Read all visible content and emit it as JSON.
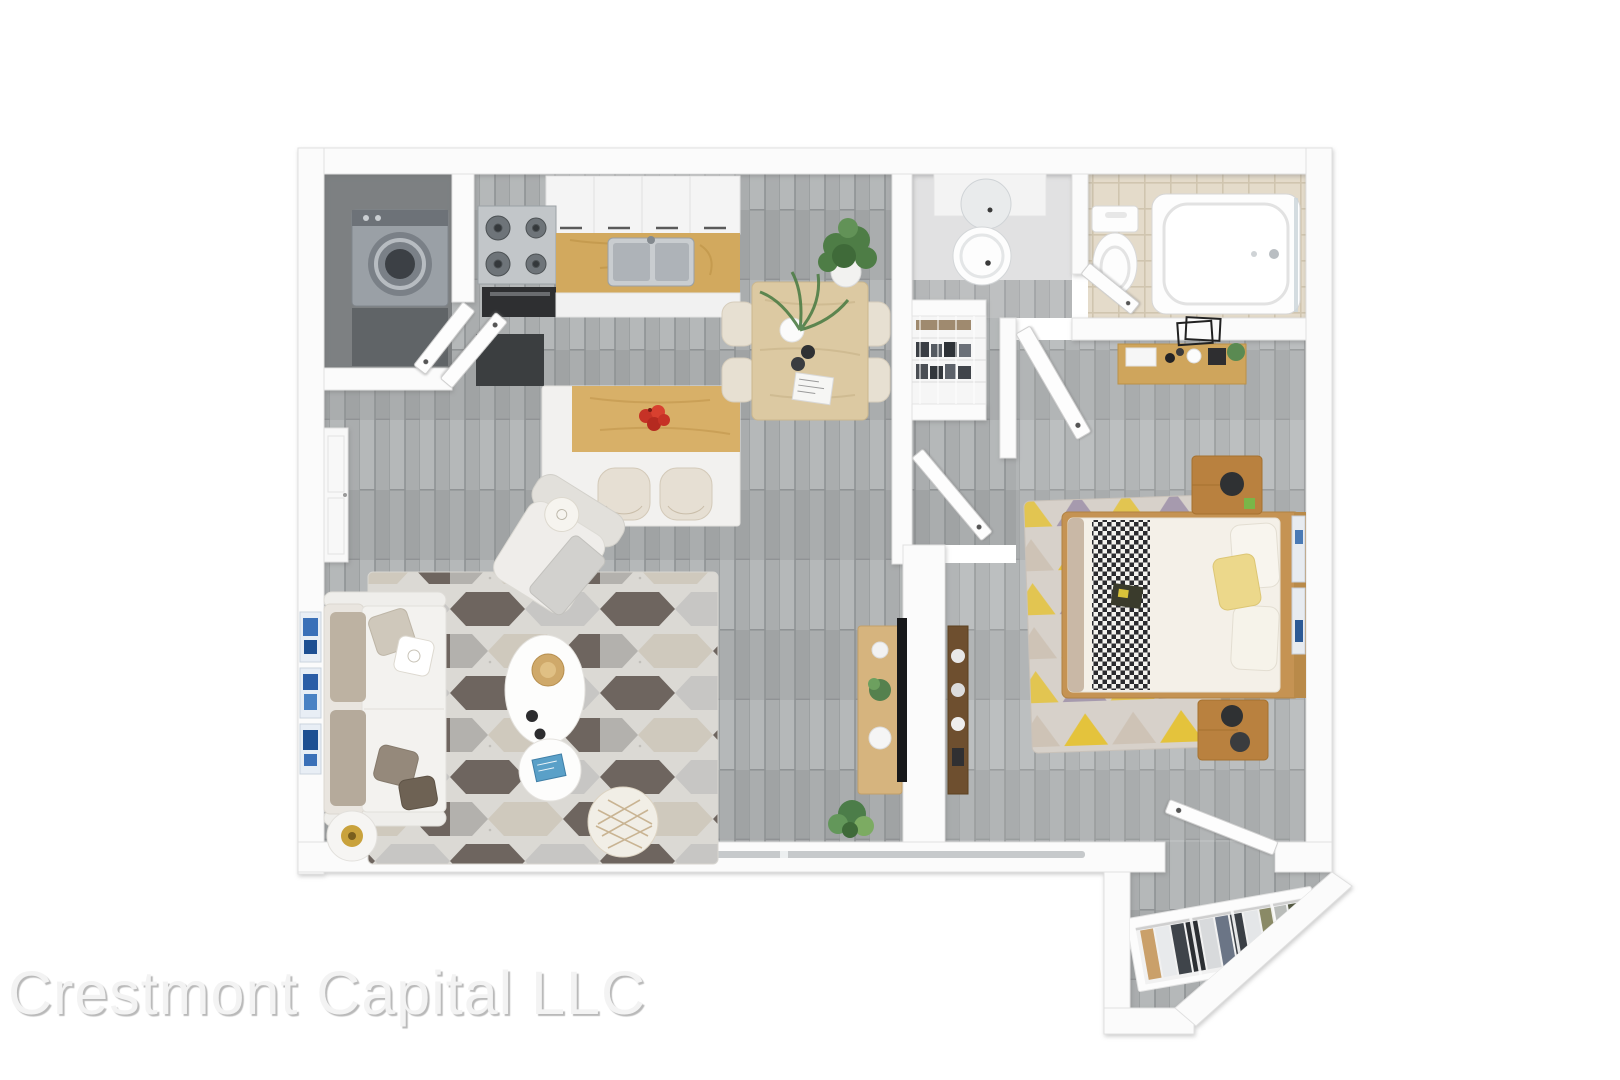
{
  "watermark": {
    "text": "Crestmont Capital LLC"
  },
  "scene": {
    "description": "3D rendered top-down floor plan of a one-bedroom apartment",
    "background_color": "#ffffff",
    "wall_color": "#fbfbfb",
    "floor_wood_gray": "#aaadae",
    "laundry_floor": "#7d8082",
    "bathroom_tile": "#e4dbca",
    "oak_wood": "#d2a95e",
    "light_table_wood": "#dcc9a2",
    "rug_dark_hex": "#6e655f",
    "bedroom_rug_yellow": "#e4c33c",
    "bedroom_rug_purple": "#a69aae",
    "sofa_cushion_taupe": "#b5aa9b",
    "pillow_yellow": "#ecd88b",
    "art_blue": "#3a70b8",
    "apple_red": "#c63226",
    "plant_green": "#55814e",
    "tv_black": "#17181a"
  },
  "rooms": [
    {
      "id": "kitchen",
      "items": [
        "laundry-closet-with-washer",
        "gas-cooktop",
        "oven",
        "upper-cabinets",
        "counter-with-double-sink",
        "kitchen-island",
        "two-bar-stools",
        "apple-bowl",
        "dark-counter"
      ]
    },
    {
      "id": "dining-area",
      "items": [
        "dining-table",
        "four-chairs",
        "tall-potted-plant",
        "palm-plant",
        "plate-and-bowls",
        "magazine"
      ]
    },
    {
      "id": "living-room",
      "items": [
        "sofa-with-pillows",
        "three-blue-artworks",
        "armchair-with-throw",
        "kidney-coffee-table",
        "round-coffee-table",
        "diamond-ottoman",
        "side-table-with-gold-lamp",
        "hexagon-pattern-rug",
        "tv",
        "tv-console",
        "floor-plants",
        "built-in-closet"
      ]
    },
    {
      "id": "hallway",
      "items": [
        "linen-closet-with-clothes",
        "open-door-to-bedroom",
        "open-door-to-hall"
      ]
    },
    {
      "id": "bathroom",
      "items": [
        "round-mirror",
        "pedestal-sink",
        "toilet",
        "bathtub",
        "glass-screen",
        "open-door"
      ]
    },
    {
      "id": "bedroom",
      "items": [
        "double-bed",
        "checkered-throw",
        "yellow-pillow",
        "two-nightstands",
        "black-table-lamps",
        "triangle-pattern-rug",
        "vanity-shelf-with-cosmetics",
        "leaning-mirror-frames",
        "wall-shelf",
        "leaning-wall-art"
      ]
    },
    {
      "id": "entry",
      "items": [
        "open-wardrobe-with-clothes",
        "entry-door",
        "diagonal-outer-wall"
      ]
    }
  ]
}
